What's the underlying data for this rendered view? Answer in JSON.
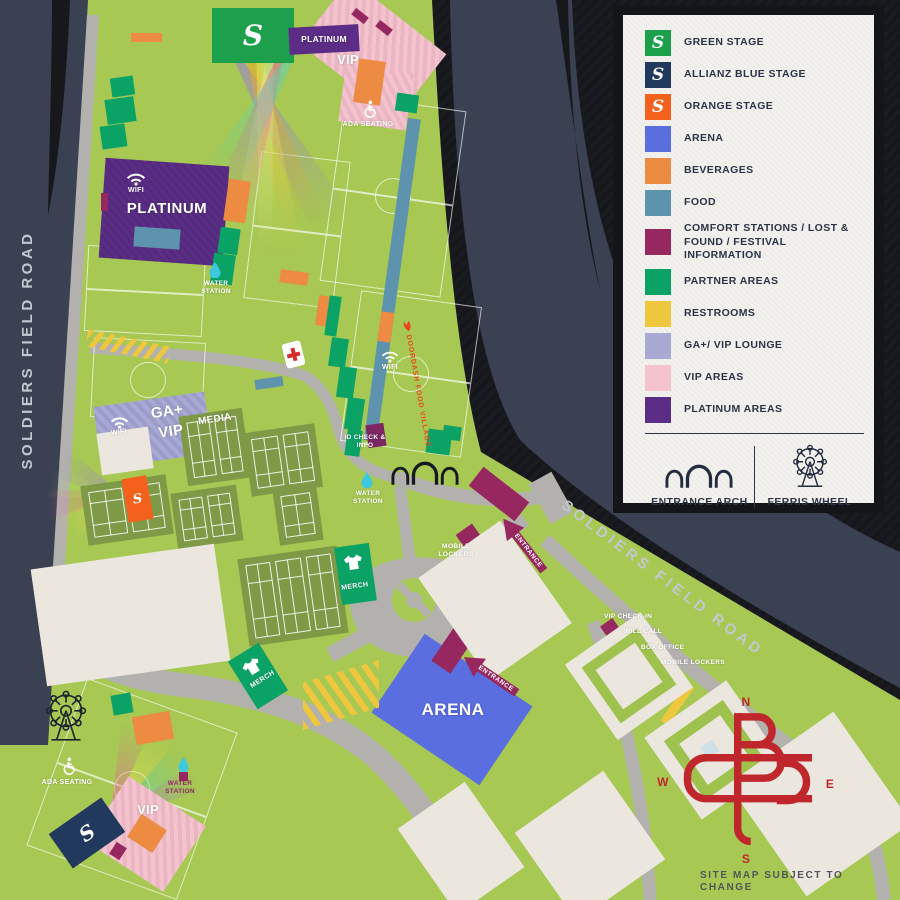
{
  "legend": {
    "items": [
      {
        "label": "GREEN STAGE",
        "color": "#1ca04b",
        "glyph": "S"
      },
      {
        "label": "ALLIANZ BLUE STAGE",
        "color": "#21395c",
        "glyph": "S"
      },
      {
        "label": "ORANGE STAGE",
        "color": "#f4611d",
        "glyph": "S"
      },
      {
        "label": "ARENA",
        "color": "#5a6ee0"
      },
      {
        "label": "BEVERAGES",
        "color": "#ec8b41"
      },
      {
        "label": "FOOD",
        "color": "#5d93ad"
      },
      {
        "label": "COMFORT STATIONS / LOST & FOUND / FESTIVAL INFORMATION",
        "color": "#97285f"
      },
      {
        "label": "PARTNER AREAS",
        "color": "#0ba266"
      },
      {
        "label": "RESTROOMS",
        "color": "#eec73f"
      },
      {
        "label": "GA+/ VIP LOUNGE",
        "color": "#a9aad3"
      },
      {
        "label": "VIP AREAS",
        "color": "#f4c3cd"
      },
      {
        "label": "PLATINUM AREAS",
        "color": "#5b2d86"
      }
    ],
    "footer": [
      {
        "label": "ENTRANCE ARCH"
      },
      {
        "label": "FERRIS WHEEL"
      }
    ]
  },
  "roads": {
    "left": "SOLDIERS FIELD ROAD",
    "right": "SOLDIERS FIELD ROAD"
  },
  "labels": {
    "platinum": "PLATINUM",
    "vip": "VIP",
    "ada": "ADA SEATING",
    "wifi": "WIFI",
    "water": "WATER STATION",
    "ga_plus": "GA+",
    "media": "MEDIA",
    "merch": "MERCH",
    "id_check": "ID CHECK & INFO",
    "mobile_lockers": "MOBILE LOCKERS",
    "entrance": "ENTRANCE",
    "arena": "ARENA",
    "vip_check_in": "VIP CHECK-IN",
    "will_call": "WILL CALL",
    "box_office": "BOX OFFICE",
    "doordash": "DOORDASH FOOD VILLAGE",
    "stage_glyph": "S",
    "disclaimer": "SITE MAP SUBJECT TO CHANGE"
  },
  "compass": {
    "n": "N",
    "e": "E",
    "s": "S",
    "w": "W"
  }
}
